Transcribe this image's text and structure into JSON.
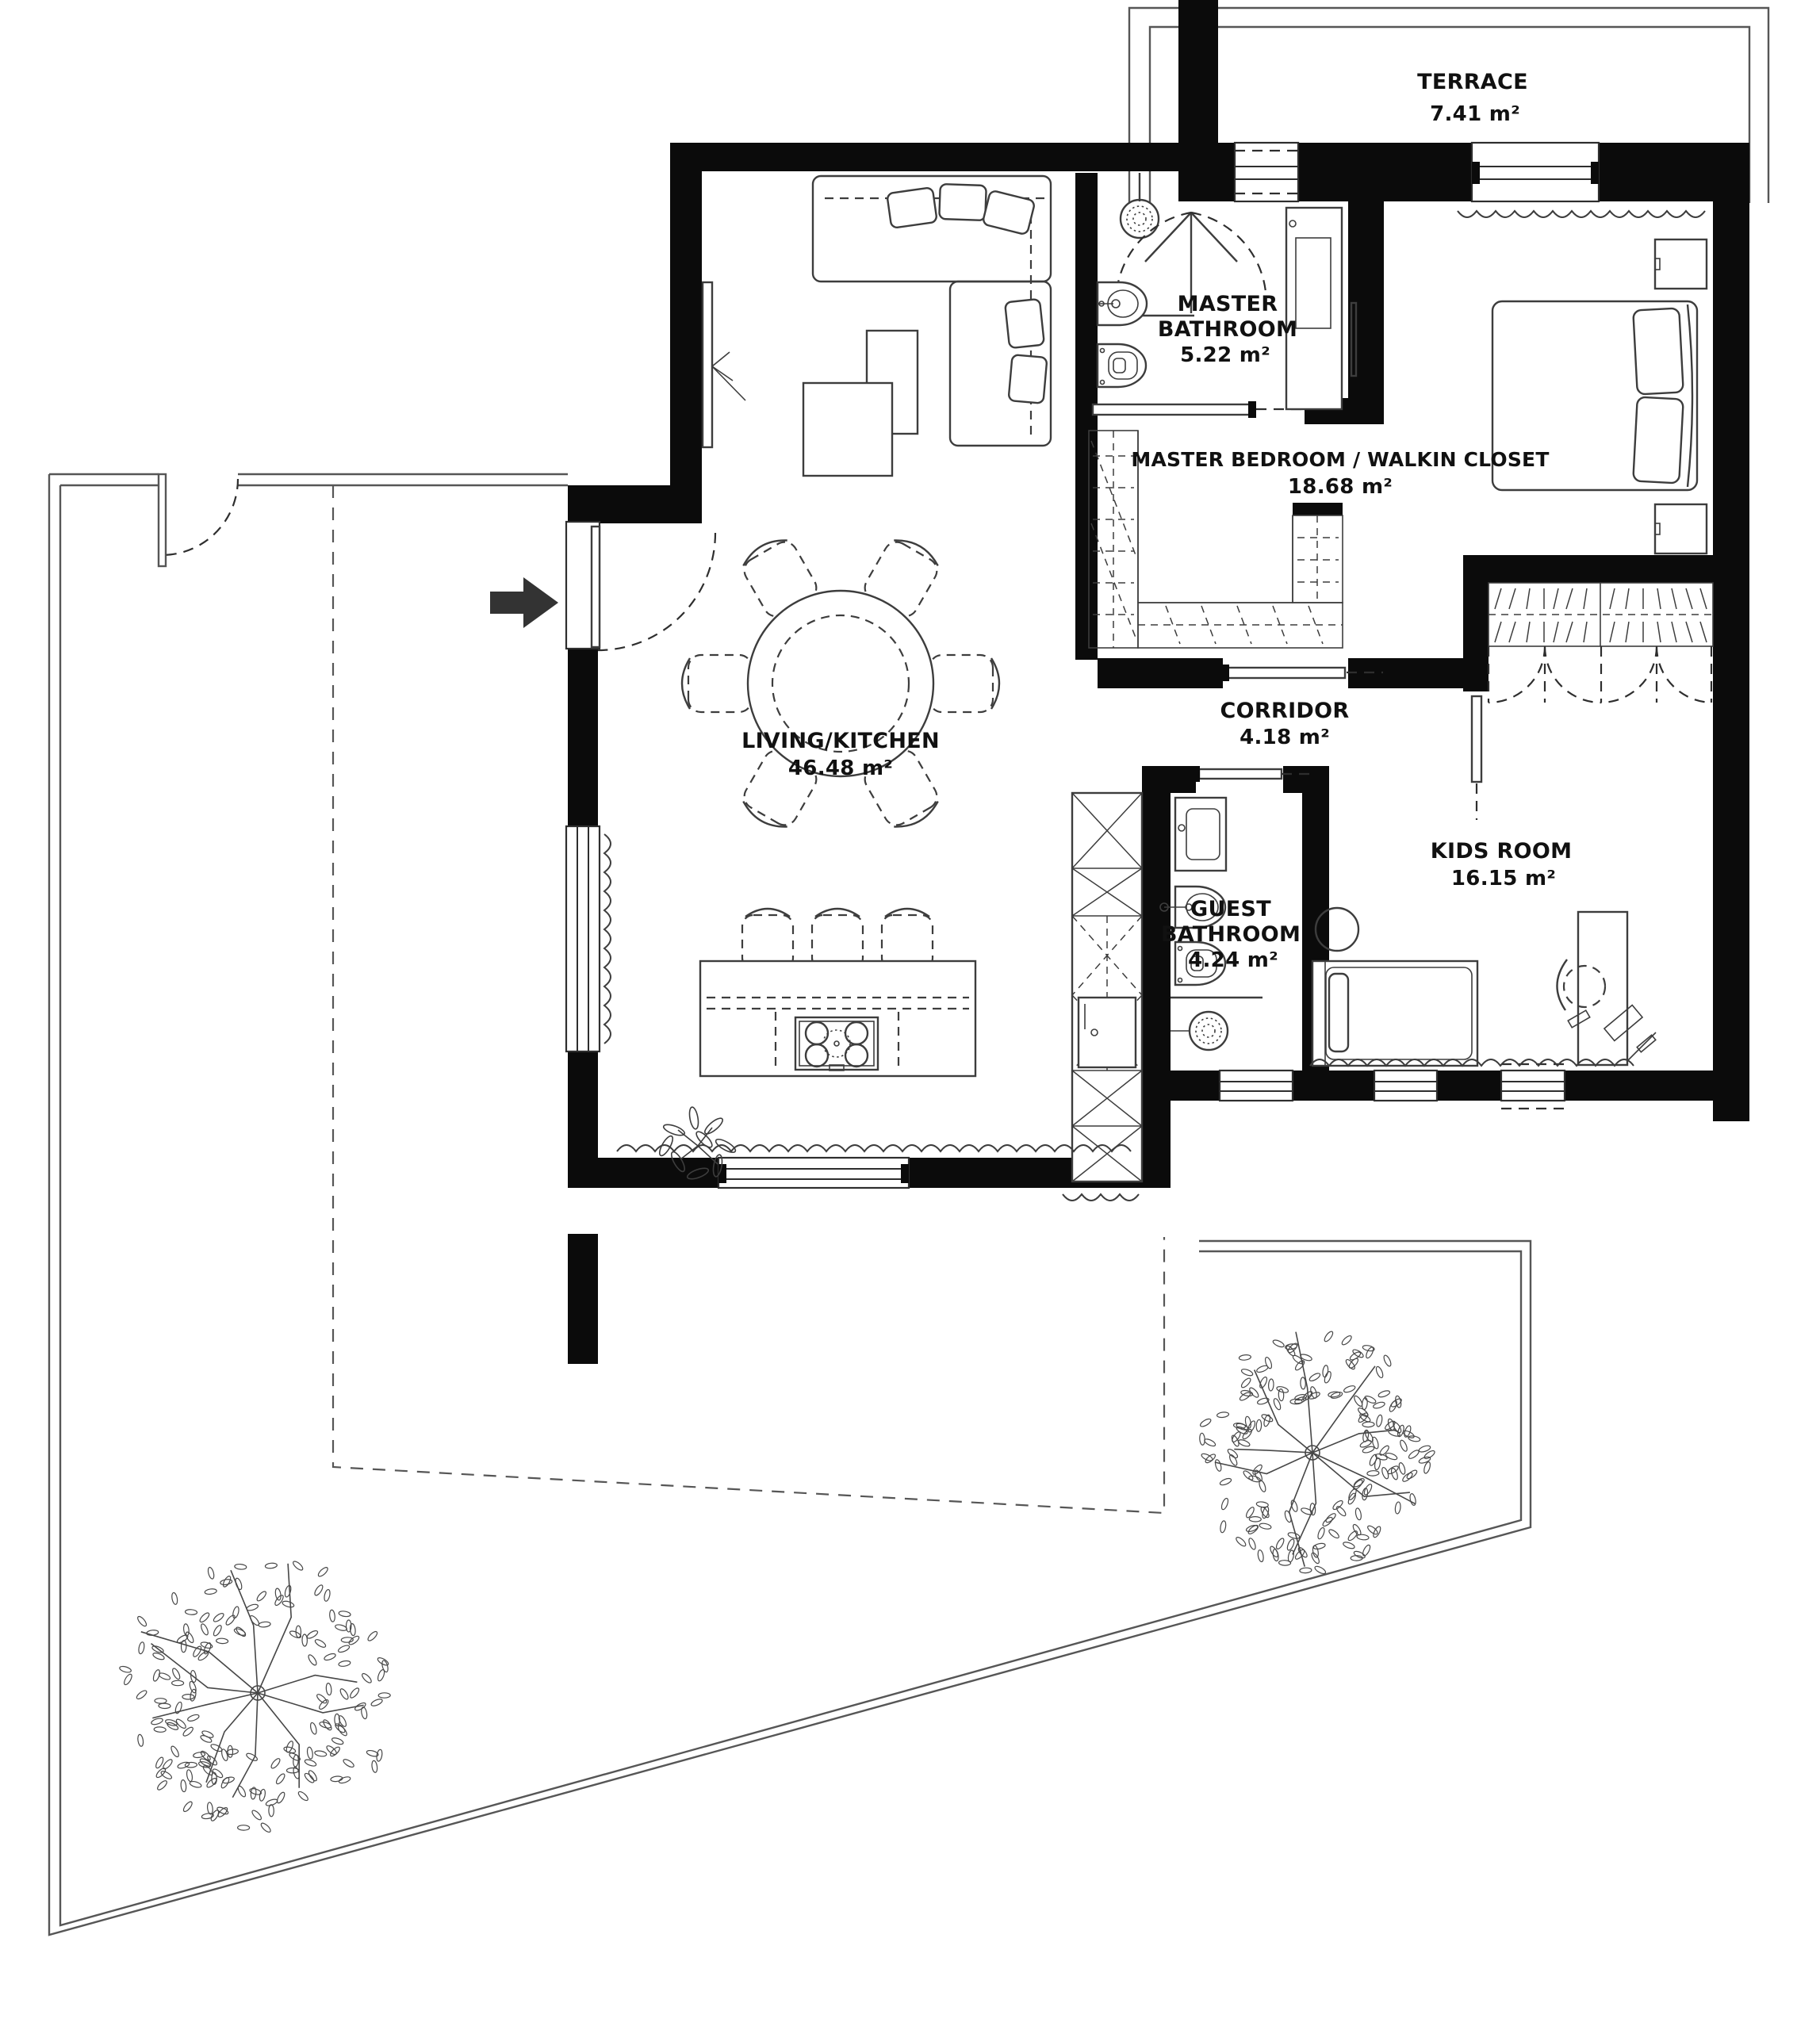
{
  "rooms": [
    {
      "id": "terrace",
      "name": "TERRACE",
      "area": "7.41 m²"
    },
    {
      "id": "master_bathroom",
      "line1": "MASTER",
      "line2": "BATHROOM",
      "area": "5.22 m²"
    },
    {
      "id": "master_bedroom",
      "name": "MASTER BEDROOM / WALKIN CLOSET",
      "area": "18.68 m²"
    },
    {
      "id": "corridor",
      "name": "CORRIDOR",
      "area": "4.18 m²"
    },
    {
      "id": "living_kitchen",
      "name": "LIVING/KITCHEN",
      "area": "46.48 m²"
    },
    {
      "id": "guest_bathroom",
      "line1": "GUEST",
      "line2": "BATHROOM",
      "area": "4.24 m²"
    },
    {
      "id": "kids_room",
      "name": "KIDS ROOM",
      "area": "16.15 m²"
    }
  ],
  "colors": {
    "wall": "#0b0b0b",
    "furniture_line": "#3d3d3d",
    "boundary": "#565656",
    "text": "#111111",
    "arrow": "#333333"
  }
}
